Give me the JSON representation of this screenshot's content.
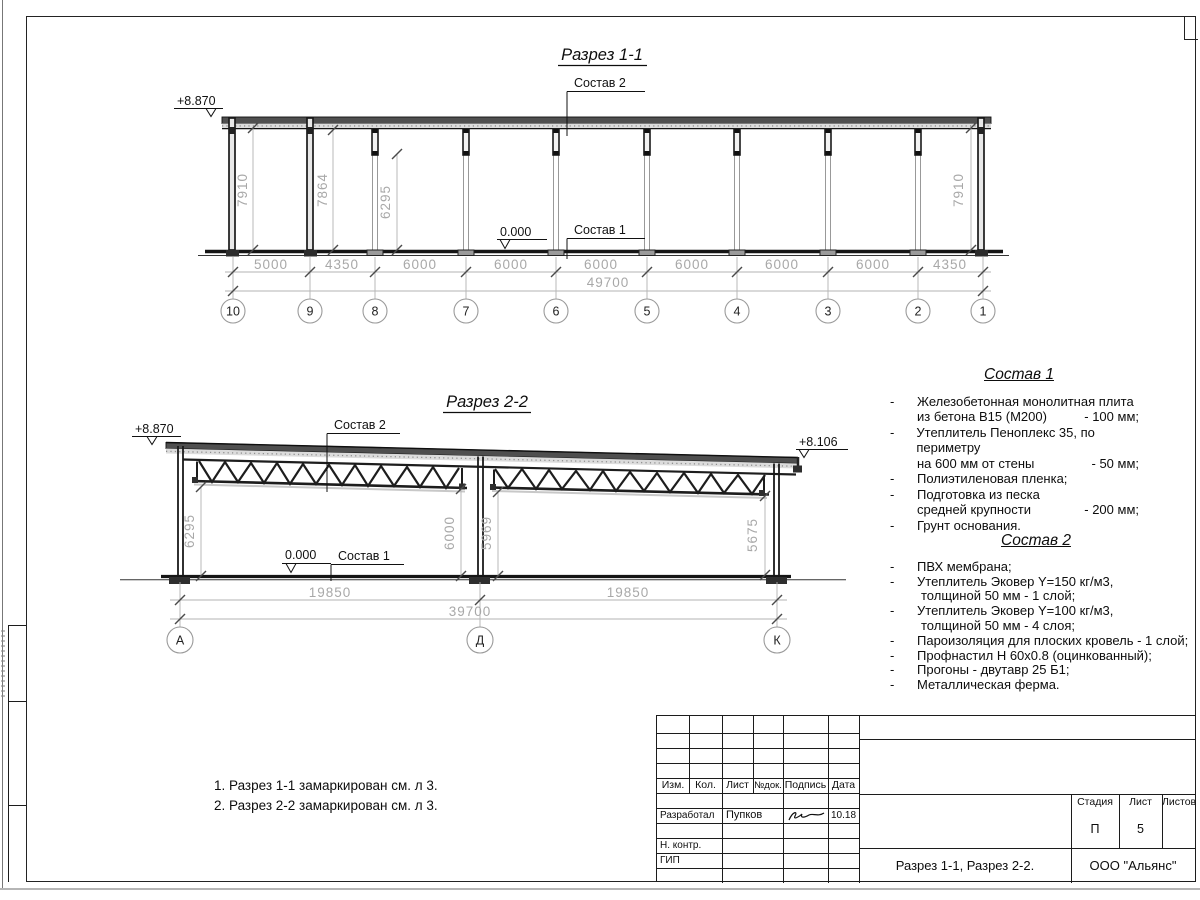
{
  "dash": "-",
  "section_1_1": {
    "title": "Разрез 1-1",
    "elev_left": "+8.870",
    "zero_mark": "0.000",
    "label_sostav2": "Состав 2",
    "label_sostav1": "Состав 1",
    "vdims": [
      "7910",
      "7864",
      "6295",
      "7910"
    ],
    "dims": [
      "5000",
      "4350",
      "6000",
      "6000",
      "6000",
      "6000",
      "6000",
      "6000",
      "4350"
    ],
    "total": "49700",
    "grids": [
      "10",
      "9",
      "8",
      "7",
      "6",
      "5",
      "4",
      "3",
      "2",
      "1"
    ]
  },
  "section_2_2": {
    "title": "Разрез 2-2",
    "elev_left": "+8.870",
    "elev_right": "+8.106",
    "zero_mark": "0.000",
    "label_sostav2": "Состав 2",
    "label_sostav1": "Состав 1",
    "vdims": [
      "6295",
      "6000",
      "5969",
      "5675"
    ],
    "dims": [
      "19850",
      "19850"
    ],
    "total": "39700",
    "grids": [
      "А",
      "Д",
      "К"
    ]
  },
  "composition_1": {
    "title": "Состав 1",
    "items": [
      {
        "lines": [
          {
            "t": "Железобетонная  монолитная плита"
          },
          {
            "t": "из бетона В15 (М200)",
            "v": "- 100 мм;"
          }
        ]
      },
      {
        "lines": [
          {
            "t": "Утеплитель Пеноплекс 35, по периметру"
          },
          {
            "t": "на 600 мм от стены",
            "v": "- 50 мм;"
          }
        ]
      },
      {
        "lines": [
          {
            "t": "Полиэтиленовая пленка;"
          }
        ]
      },
      {
        "lines": [
          {
            "t": "Подготовка из песка"
          },
          {
            "t": "средней крупности",
            "v": "- 200 мм;"
          }
        ]
      },
      {
        "lines": [
          {
            "t": "Грунт основания."
          }
        ]
      }
    ]
  },
  "composition_2": {
    "title": "Состав 2",
    "items": [
      {
        "lines": [
          {
            "t": "ПВХ мембрана;"
          }
        ]
      },
      {
        "lines": [
          {
            "t": "Утеплитель Эковер Y=150 кг/м3,"
          },
          {
            "t": "толщиной 50 мм - 1 слой;"
          }
        ]
      },
      {
        "lines": [
          {
            "t": "Утеплитель Эковер Y=100 кг/м3,"
          },
          {
            "t": "толщиной 50 мм - 4 слоя;"
          }
        ]
      },
      {
        "lines": [
          {
            "t": "Пароизоляция для плоских кровель - 1 слой;"
          }
        ]
      },
      {
        "lines": [
          {
            "t": "Профнастил Н 60х0.8 (оцинкованный);"
          }
        ]
      },
      {
        "lines": [
          {
            "t": "Прогоны - двутавр 25 Б1;"
          }
        ]
      },
      {
        "lines": [
          {
            "t": "Металлическая ферма."
          }
        ]
      }
    ]
  },
  "notes": [
    "1. Разрез 1-1 замаркирован см. л 3.",
    "2. Разрез 2-2 замаркирован см. л 3."
  ],
  "title_block": {
    "header_cols": [
      "Изм.",
      "Кол.",
      "Лист",
      "№док.",
      "Подпись",
      "Дата"
    ],
    "developer_label": "Разработал",
    "developer_name": "Пупков",
    "date": "10.18",
    "ncontrol_label": "Н. контр.",
    "gip_label": "ГИП",
    "stage_label": "Стадия",
    "sheet_label": "Лист",
    "sheets_label": "Листов",
    "stage_value": "П",
    "sheet_value": "5",
    "doc_name": "Разрез 1-1, Разрез 2-2.",
    "org_name": "ООО \"Альянс\""
  }
}
